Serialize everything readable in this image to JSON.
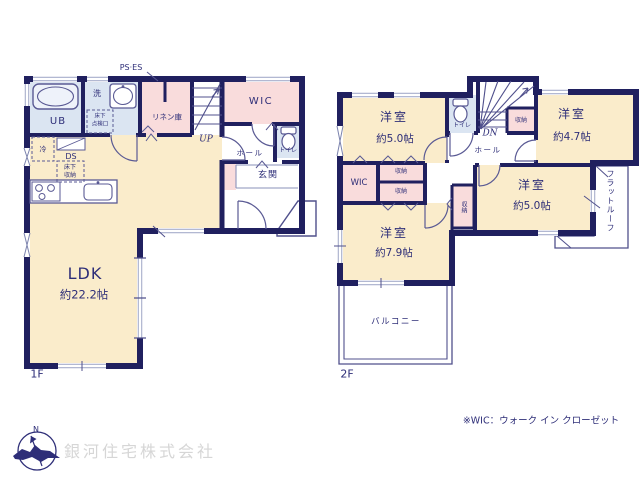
{
  "palette": {
    "wall_navy": "#20205f",
    "text_navy": "#2e2e78",
    "room_cream": "#faeccb",
    "room_pink": "#f9dcdc",
    "room_blue": "#dbe5f2",
    "fixture_line": "#5a5a94",
    "window_line": "#a7aecb",
    "company_gray": "#d6d6d6"
  },
  "floor1": {
    "floor_label": "1F",
    "ps_es": "PS·ES",
    "bath": "UB",
    "wash": "洗",
    "inspection_l1": "床下",
    "inspection_l2": "点検口",
    "fridge": "冷",
    "duct": "DS",
    "underfloor_l1": "床下",
    "underfloor_l2": "収納",
    "linen": "リネン庫",
    "stairs_up": "UP",
    "wic": "WIC",
    "hall": "ホール",
    "toilet": "トイレ",
    "entrance": "玄関",
    "ldk_name": "LDK",
    "ldk_size": "約22.2帖"
  },
  "floor2": {
    "floor_label": "2F",
    "room_nw_name": "洋室",
    "room_nw_size": "約5.0帖",
    "toilet": "トイレ",
    "stairs_dn": "DN",
    "stair_closet": "収納",
    "room_ne_name": "洋室",
    "room_ne_size": "約4.7帖",
    "hall": "ホール",
    "wic": "WIC",
    "closet_a": "収納",
    "closet_b": "収納",
    "closet_c": "収納",
    "room_e_name": "洋室",
    "room_e_size": "約5.0帖",
    "flat_roof": "フラットルーフ",
    "room_sw_name": "洋室",
    "room_sw_size": "約7.9帖",
    "balcony": "バルコニー"
  },
  "footer": {
    "wic_note": "※WIC：ウォーク イン クローゼット",
    "company": "銀河住宅株式会社",
    "compass_n": "N"
  }
}
